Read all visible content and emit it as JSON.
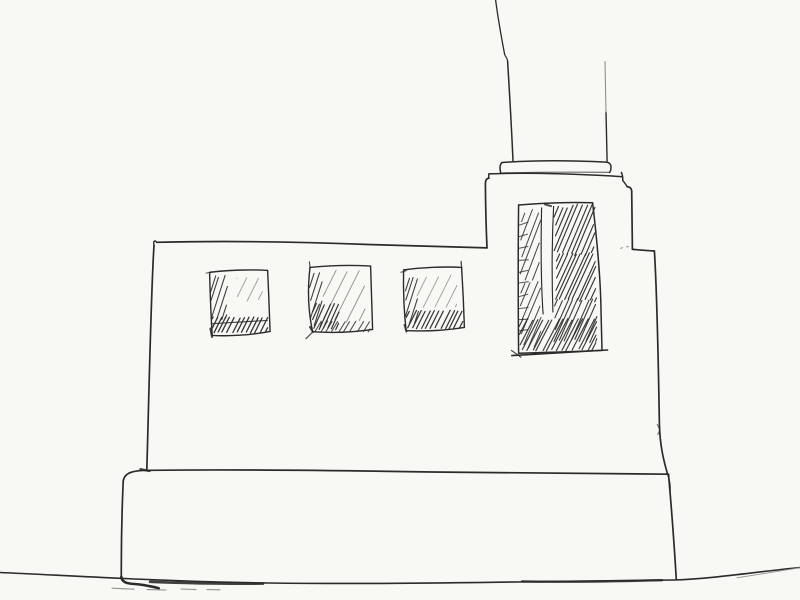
{
  "scene": {
    "type": "ink-sketch",
    "title": "Hand-drawn pen sketch of a flat-roofed industrial building with a tall chimney",
    "description": "Freehand black ink line drawing on off-white paper: a wide low building on a plinth base sitting on a ground line, three small square windows with diagonal hatching, a rooftop tower with a tall densely hatched window, and a chimney with a capped collar rising off the top of the frame.",
    "elements": [
      "ground-line",
      "plinth-base",
      "building-body",
      "roof-line",
      "rooftop-tower",
      "chimney",
      "chimney-cap",
      "chimney-collar",
      "window-1",
      "window-2",
      "window-3",
      "tall-tower-window"
    ]
  },
  "colors": {
    "paper": "#f8f8f5",
    "ink": "#2b2b2b",
    "ink_faint": "#90908c"
  },
  "counts": {
    "windows_total": 4,
    "square_windows": 3,
    "tall_windows": 1,
    "chimneys": 1
  },
  "hatch_regions": [
    {
      "n": "window1-left-strip",
      "x": 210.5,
      "y": 274,
      "w": 17,
      "h": 46,
      "slope": 0.32,
      "sp": 5,
      "wd": 1.1,
      "op": 0.9
    },
    {
      "n": "window1-bottom-band",
      "x": 212,
      "y": 317,
      "w": 56,
      "h": 16,
      "slope": 0.5,
      "sp": 4.6,
      "wd": 1.3,
      "op": 0.95
    },
    {
      "n": "window1-reflection",
      "x": 237,
      "y": 277,
      "w": 26,
      "h": 24,
      "slope": 0.5,
      "sp": 11,
      "wd": 0.9,
      "op": 0.45
    },
    {
      "n": "window2-left-strip",
      "x": 309.5,
      "y": 272,
      "w": 13,
      "h": 57,
      "slope": 0.32,
      "sp": 5.4,
      "wd": 1.1,
      "op": 0.9
    },
    {
      "n": "window2-corner",
      "x": 312,
      "y": 303,
      "w": 27,
      "h": 27,
      "slope": 0.45,
      "sp": 4.6,
      "wd": 1.2,
      "op": 0.95
    },
    {
      "n": "window2-bottom-band",
      "x": 315,
      "y": 321,
      "w": 55,
      "h": 11,
      "slope": 0.6,
      "sp": 6,
      "wd": 1.1,
      "op": 0.8
    },
    {
      "n": "window2-reflection",
      "x": 323,
      "y": 270,
      "w": 43,
      "h": 53,
      "slope": 0.5,
      "sp": 12.5,
      "wd": 0.95,
      "op": 0.5
    },
    {
      "n": "window3-left-strip",
      "x": 404.5,
      "y": 274,
      "w": 14,
      "h": 53,
      "slope": 0.32,
      "sp": 5.2,
      "wd": 1.1,
      "op": 0.9
    },
    {
      "n": "window3-bottom-band",
      "x": 406,
      "y": 310,
      "w": 57,
      "h": 19,
      "slope": 0.5,
      "sp": 4.8,
      "wd": 1.25,
      "op": 0.95
    },
    {
      "n": "window3-reflection",
      "x": 417,
      "y": 275,
      "w": 40,
      "h": 34,
      "slope": 0.5,
      "sp": 11,
      "wd": 0.9,
      "op": 0.45
    },
    {
      "n": "tall-window-left-upper",
      "x": 520,
      "y": 209,
      "w": 21,
      "h": 72,
      "slope": 0.38,
      "sp": 6.4,
      "wd": 1.05,
      "op": 0.85
    },
    {
      "n": "tall-window-left-lower",
      "x": 520,
      "y": 280,
      "w": 21,
      "h": 68,
      "slope": 0.42,
      "sp": 6,
      "wd": 1.05,
      "op": 0.85
    },
    {
      "n": "tall-window-right-upper",
      "x": 554,
      "y": 204,
      "w": 41,
      "h": 52,
      "slope": 0.42,
      "sp": 4.8,
      "wd": 1.15,
      "op": 0.95
    },
    {
      "n": "tall-window-right-middle",
      "x": 555,
      "y": 252,
      "w": 42,
      "h": 50,
      "slope": 0.46,
      "sp": 4.4,
      "wd": 1.15,
      "op": 0.95
    },
    {
      "n": "tall-window-right-lower",
      "x": 554,
      "y": 298,
      "w": 43,
      "h": 45,
      "slope": 0.44,
      "sp": 5,
      "wd": 1.15,
      "op": 0.9
    },
    {
      "n": "tall-window-bottom-band",
      "x": 519,
      "y": 318,
      "w": 78,
      "h": 33,
      "slope": 0.52,
      "sp": 5,
      "wd": 1.2,
      "op": 0.9
    },
    {
      "n": "tall-window-ladder-ticks",
      "x": 519,
      "y": 224,
      "w": 9,
      "h": 110,
      "mode": "h",
      "slope": 0.15,
      "sp": 12,
      "wd": 1.05,
      "op": 0.75
    }
  ]
}
